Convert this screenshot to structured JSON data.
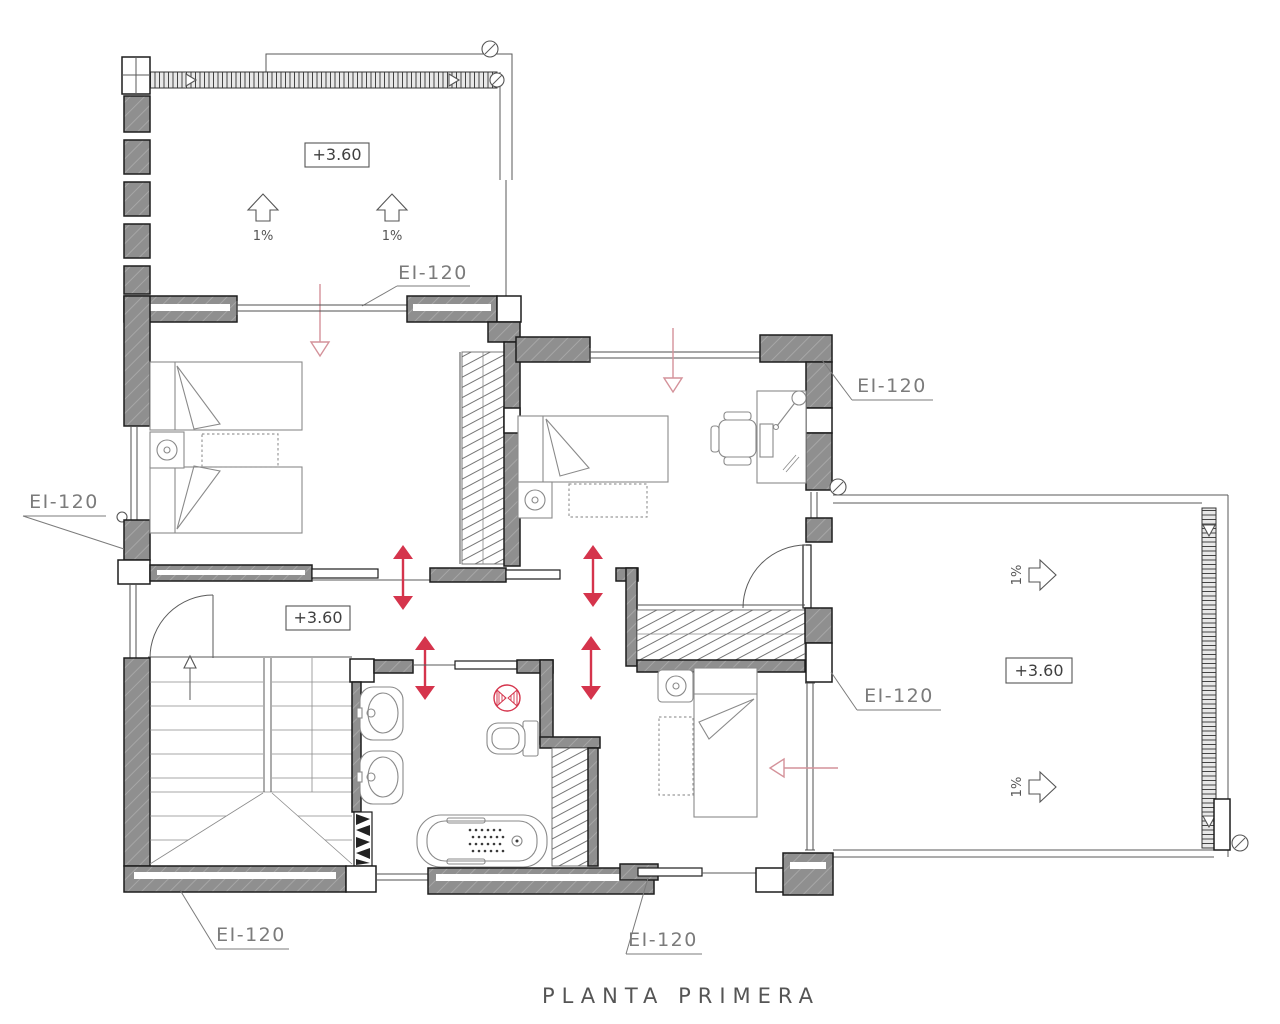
{
  "drawing": {
    "title": "PLANTA PRIMERA",
    "labels": {
      "fire_rating": "EI-120",
      "level": "+3.60",
      "slope": "1%"
    }
  },
  "colors": {
    "accent_red": "#d5344c",
    "accent_red_soft": "#d4929a",
    "wall_gray": "#8f8f8f",
    "line_dark": "#1d1d1d",
    "text_gray": "#7b7b7b"
  }
}
